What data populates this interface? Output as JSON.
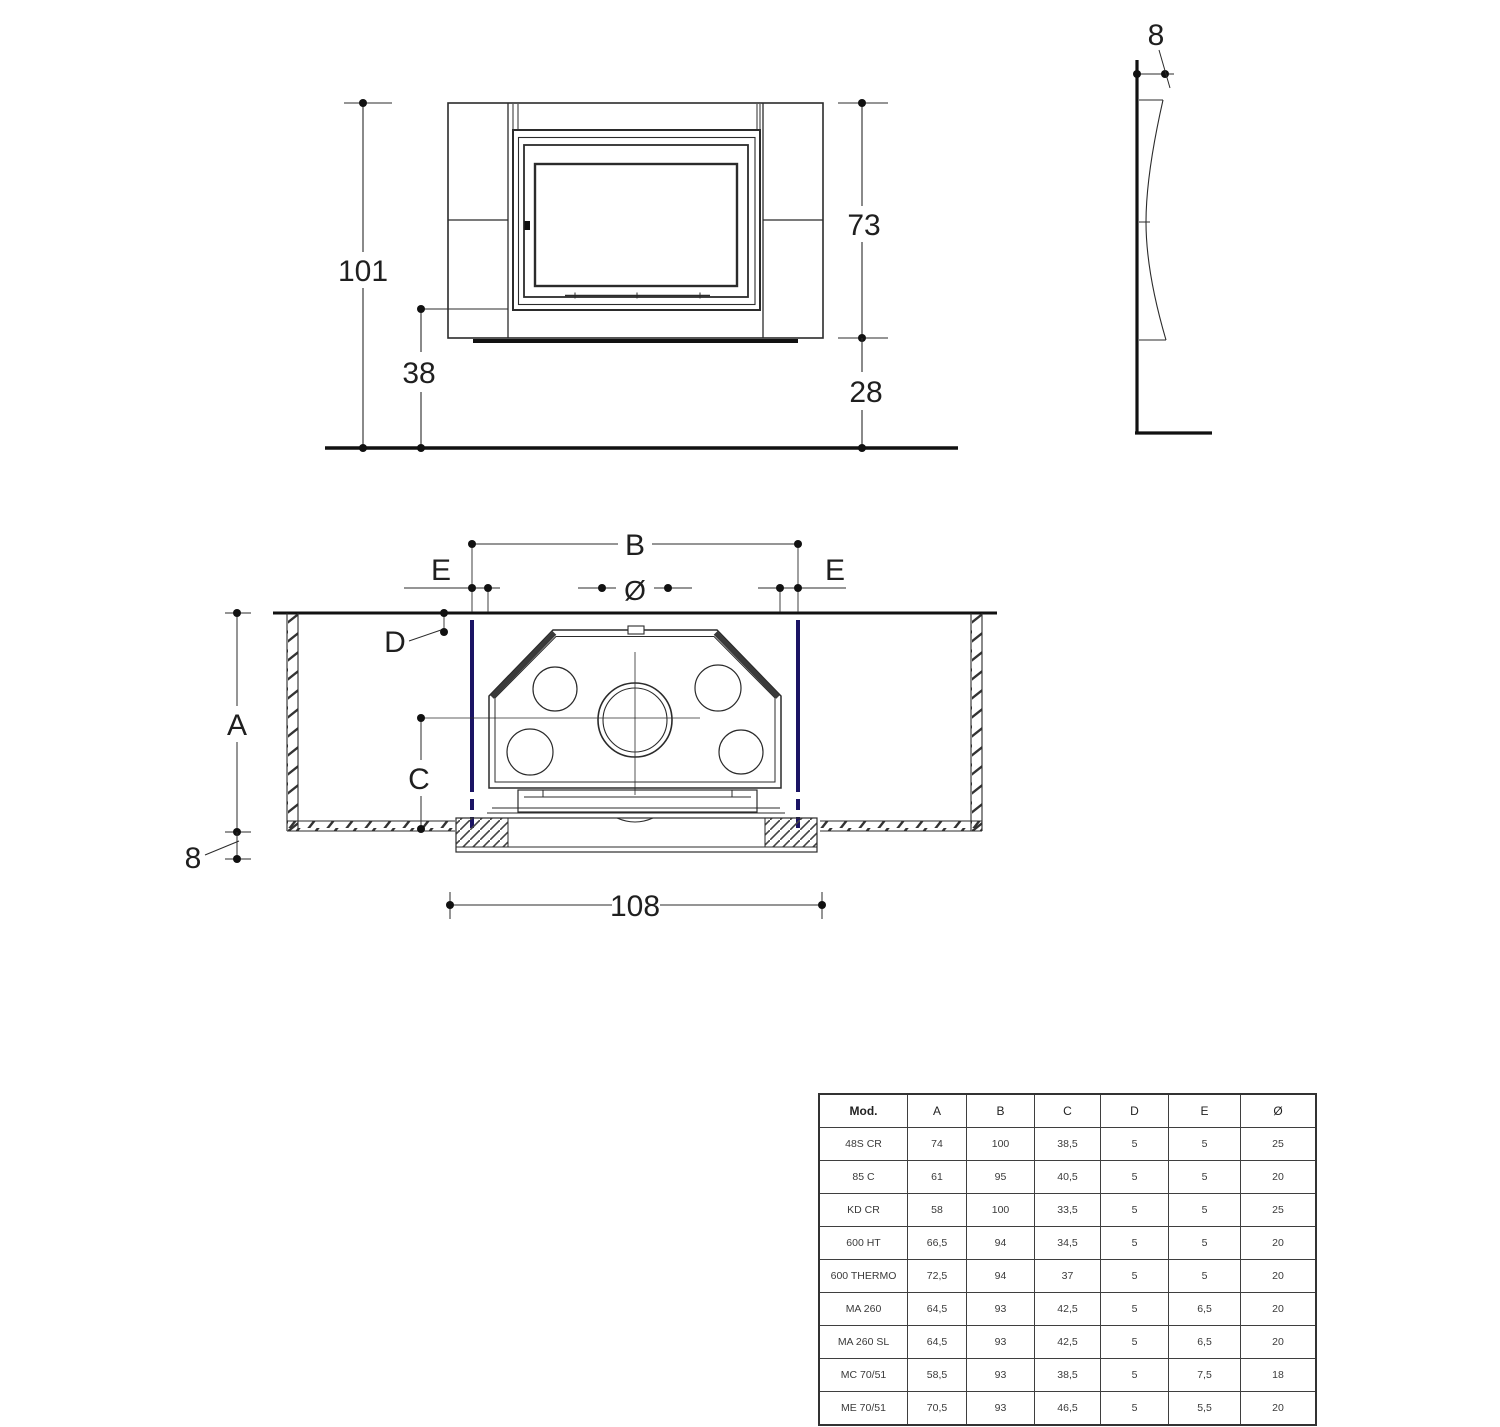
{
  "colors": {
    "line": "#2b2b2b",
    "thick_line": "#111111",
    "accent_blue": "#1b1464",
    "table_border": "#3f3f3f",
    "text": "#1f1f1f"
  },
  "front_view": {
    "dim_height_total": "101",
    "dim_insert_height": "73",
    "dim_hearth_height": "38",
    "dim_base_height": "28"
  },
  "side_view": {
    "dim_thickness": "8"
  },
  "plan_view": {
    "dim_B": "B",
    "dim_E_left": "E",
    "dim_E_right": "E",
    "dim_diameter": "Ø",
    "dim_D": "D",
    "dim_A": "A",
    "dim_C": "C",
    "dim_wall": "8",
    "dim_width_total": "108"
  },
  "table": {
    "headers": [
      "Mod.",
      "A",
      "B",
      "C",
      "D",
      "E",
      "Ø"
    ],
    "rows": [
      [
        "48S CR",
        "74",
        "100",
        "38,5",
        "5",
        "5",
        "25"
      ],
      [
        "85 C",
        "61",
        "95",
        "40,5",
        "5",
        "5",
        "20"
      ],
      [
        "KD CR",
        "58",
        "100",
        "33,5",
        "5",
        "5",
        "25"
      ],
      [
        "600 HT",
        "66,5",
        "94",
        "34,5",
        "5",
        "5",
        "20"
      ],
      [
        "600 THERMO",
        "72,5",
        "94",
        "37",
        "5",
        "5",
        "20"
      ],
      [
        "MA 260",
        "64,5",
        "93",
        "42,5",
        "5",
        "6,5",
        "20"
      ],
      [
        "MA 260 SL",
        "64,5",
        "93",
        "42,5",
        "5",
        "6,5",
        "20"
      ],
      [
        "MC 70/51",
        "58,5",
        "93",
        "38,5",
        "5",
        "7,5",
        "18"
      ],
      [
        "ME 70/51",
        "70,5",
        "93",
        "46,5",
        "5",
        "5,5",
        "20"
      ]
    ]
  }
}
